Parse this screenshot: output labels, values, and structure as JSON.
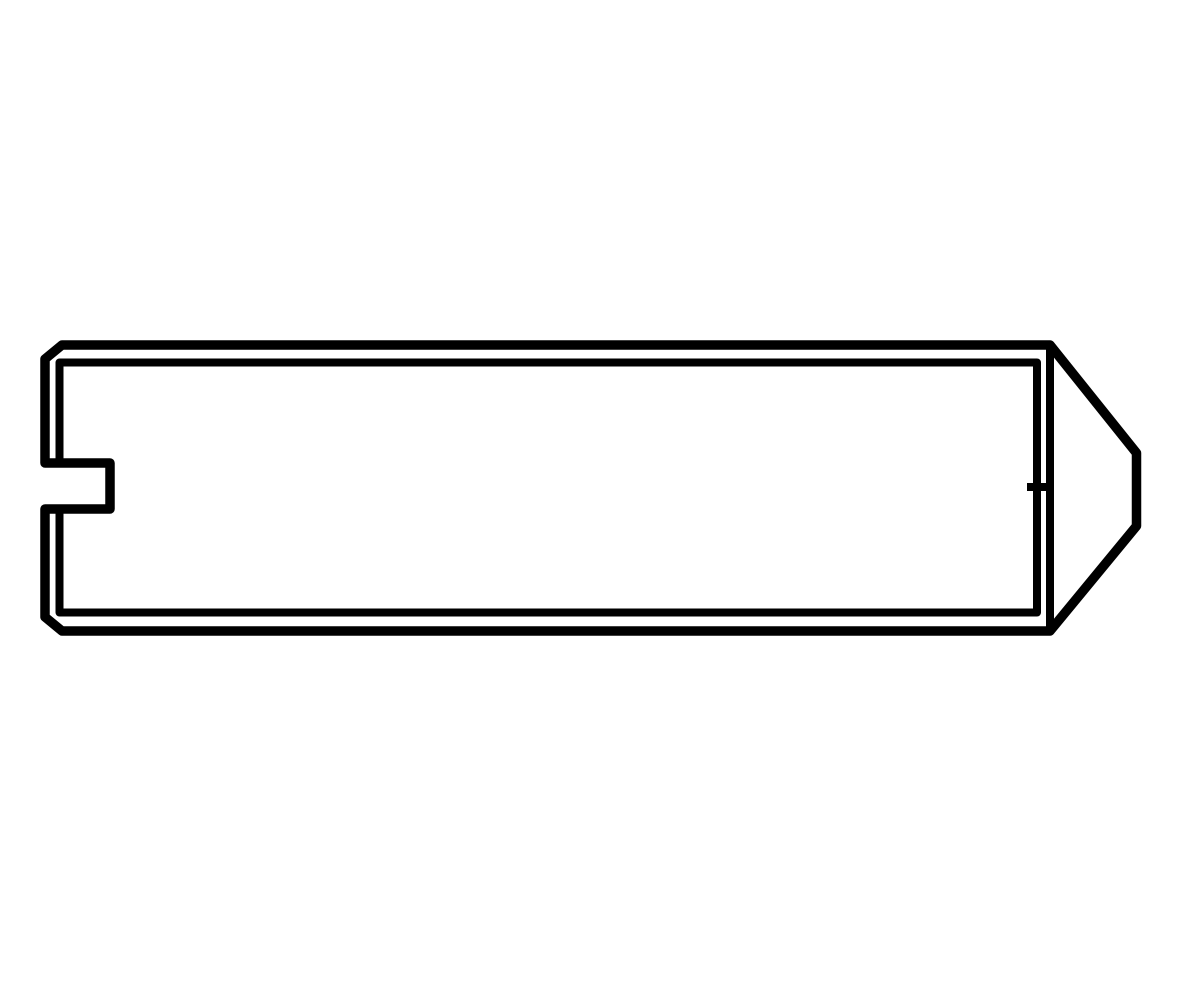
{
  "canvas": {
    "width": 1200,
    "height": 1000,
    "background": "#ffffff"
  },
  "colors": {
    "line": "#000000"
  },
  "drawing": {
    "kind": "technical-line-drawing",
    "subject": "slotted-set-screw-with-cone-point-side-view",
    "stroke": {
      "outer_width": 9.5,
      "inner_width": 8
    },
    "paths": {
      "outer_contour": "M 62 345 H 1050 L 1136.5 453 V 526 L 1050 631 H 62 L 45 617 V 509 H 110 V 463 H 45 V 359 Z",
      "thread_root_lines": "M 59.5 463 V 362.5 H 1037 V 612.5 H 59.5 V 509",
      "cone_base_line": "M 1050 345 V 631",
      "point_center_tick": "M 1027 487 H 1049"
    }
  }
}
